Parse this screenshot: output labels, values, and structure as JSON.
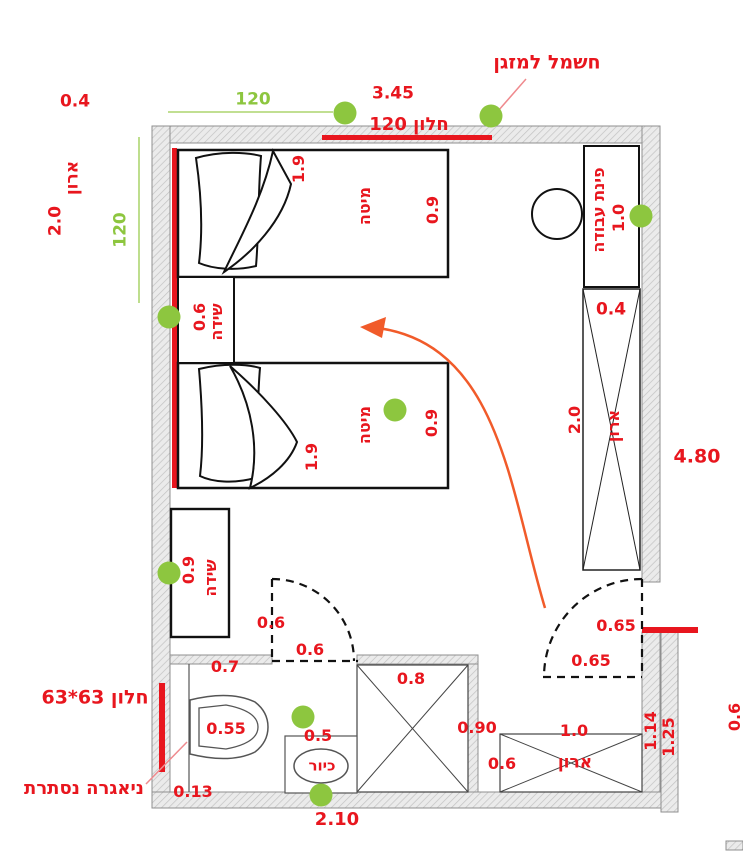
{
  "title": "children bedroom floor plan",
  "colors": {
    "red": "#e8161e",
    "green": "#8dc63f",
    "orange": "#f15b2a",
    "wall": "#ebebeb"
  },
  "labels": {
    "closet_left_depth": "0.4",
    "closet_left_name": "ארון",
    "closet_left_length": "2.0",
    "green_dim_left": "120",
    "green_dim_top": "120",
    "top_wall_length": "3.45",
    "window_top": "חלון 120",
    "ac_power": "חשמל למזגן",
    "bed1_length": "1.9",
    "bed1_name": "מיטה",
    "bed1_width": "0.9",
    "nightstand_width": "0.6",
    "nightstand_name": "שידה",
    "bed2_length": "1.9",
    "bed2_name": "מיטה",
    "bed2_width": "0.9",
    "dresser_width": "0.9",
    "dresser_name": "שידה",
    "work_corner_name": "פינת עבודה",
    "work_corner_width": "1.0",
    "work_corner_depth": "0.4",
    "closet_right_length": "2.0",
    "closet_right_name": "ארון",
    "right_wall_length": "4.80",
    "door_main_dim_a": "0.65",
    "door_main_dim_b": "0.65",
    "door_bath_dim_a": "0.6",
    "door_bath_dim_b": "0.6",
    "bath_wall_dim": "0.7",
    "bath_window": "חלון 63*63",
    "toilet_width": "0.55",
    "cistern_name": "ניאגרה נסתרת",
    "cistern_depth": "0.13",
    "sink_width": "0.5",
    "sink_name": "כיור",
    "bath_width": "2.10",
    "bath_cabinet_dim": "0.8",
    "bath_cabinet_side": "0.90",
    "closet_bottom_length": "1.0",
    "closet_bottom_depth": "0.6",
    "closet_bottom_name": "ארון",
    "wall_segment_inner": "1.14",
    "wall_segment_outer": "1.25",
    "right_wall_bottom": "0.6"
  }
}
